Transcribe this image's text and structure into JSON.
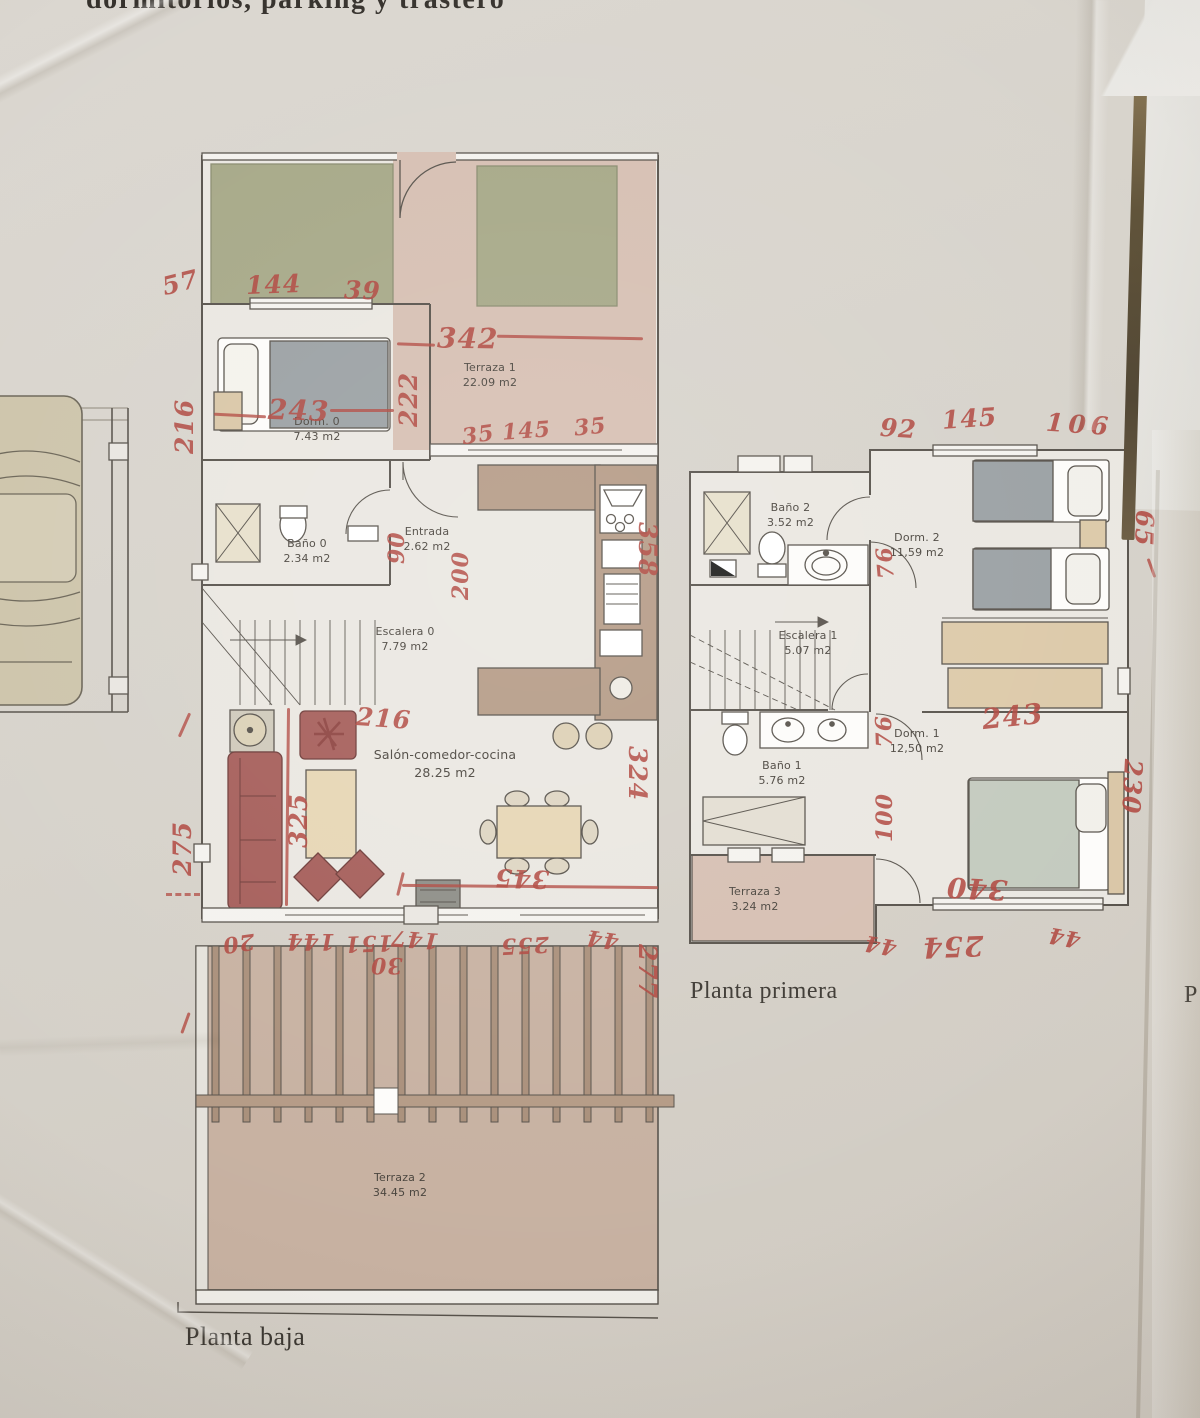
{
  "header": {
    "fragment": "dormitorios, parking y trastero"
  },
  "captions": {
    "planta_baja": "Planta baja",
    "planta_primera": "Planta primera",
    "partial_right": "P"
  },
  "plans": {
    "planta_baja": {
      "rooms": [
        {
          "name": "Terraza 1",
          "area": "22.09 m2"
        },
        {
          "name": "Dorm. 0",
          "area": "7.43 m2"
        },
        {
          "name": "Baño 0",
          "area": "2.34 m2"
        },
        {
          "name": "Entrada",
          "area": "2.62 m2"
        },
        {
          "name": "Escalera 0",
          "area": "7.79 m2"
        },
        {
          "name": "Salón-comedor-cocina",
          "area": "28.25 m2"
        },
        {
          "name": "Terraza 2",
          "area": "34.45 m2"
        }
      ],
      "annotations": [
        {
          "text": "57"
        },
        {
          "text": "144"
        },
        {
          "text": "39"
        },
        {
          "text": "342"
        },
        {
          "text": "222"
        },
        {
          "text": "216"
        },
        {
          "text": "243"
        },
        {
          "text": "35"
        },
        {
          "text": "145"
        },
        {
          "text": "35"
        },
        {
          "text": "90"
        },
        {
          "text": "200"
        },
        {
          "text": "358"
        },
        {
          "text": "216"
        },
        {
          "text": "325"
        },
        {
          "text": "275"
        },
        {
          "text": "324"
        },
        {
          "text": "345"
        },
        {
          "text": "20"
        },
        {
          "text": "144"
        },
        {
          "text": "151"
        },
        {
          "text": "30"
        },
        {
          "text": "147"
        },
        {
          "text": "255"
        },
        {
          "text": "44"
        },
        {
          "text": "277"
        }
      ]
    },
    "planta_primera": {
      "rooms": [
        {
          "name": "Baño 2",
          "area": "3.52 m2"
        },
        {
          "name": "Dorm. 2",
          "area": "11,59 m2"
        },
        {
          "name": "Escalera 1",
          "area": "5.07 m2"
        },
        {
          "name": "Baño 1",
          "area": "5.76 m2"
        },
        {
          "name": "Dorm. 1",
          "area": "12,50 m2"
        },
        {
          "name": "Terraza 3",
          "area": "3.24 m2"
        }
      ],
      "annotations": [
        {
          "text": "92"
        },
        {
          "text": "145"
        },
        {
          "text": "106"
        },
        {
          "text": "265"
        },
        {
          "text": "76"
        },
        {
          "text": "243"
        },
        {
          "text": "76"
        },
        {
          "text": "100"
        },
        {
          "text": "230"
        },
        {
          "text": "340"
        },
        {
          "text": "44"
        },
        {
          "text": "254"
        },
        {
          "text": "44"
        }
      ]
    }
  },
  "colors": {
    "paper": "#d6d2ca",
    "ink": "#57524b",
    "annotation_red": "#b0473f",
    "garden_green": "#a6a887",
    "terrace_pink": "#d6bfb2",
    "terrace_floor": "#c7b1a1",
    "furniture_red": "#a55d59",
    "furniture_beige": "#e6d6b4",
    "bed_gray": "#9aa0a3",
    "counter_brown": "#b49a85"
  }
}
